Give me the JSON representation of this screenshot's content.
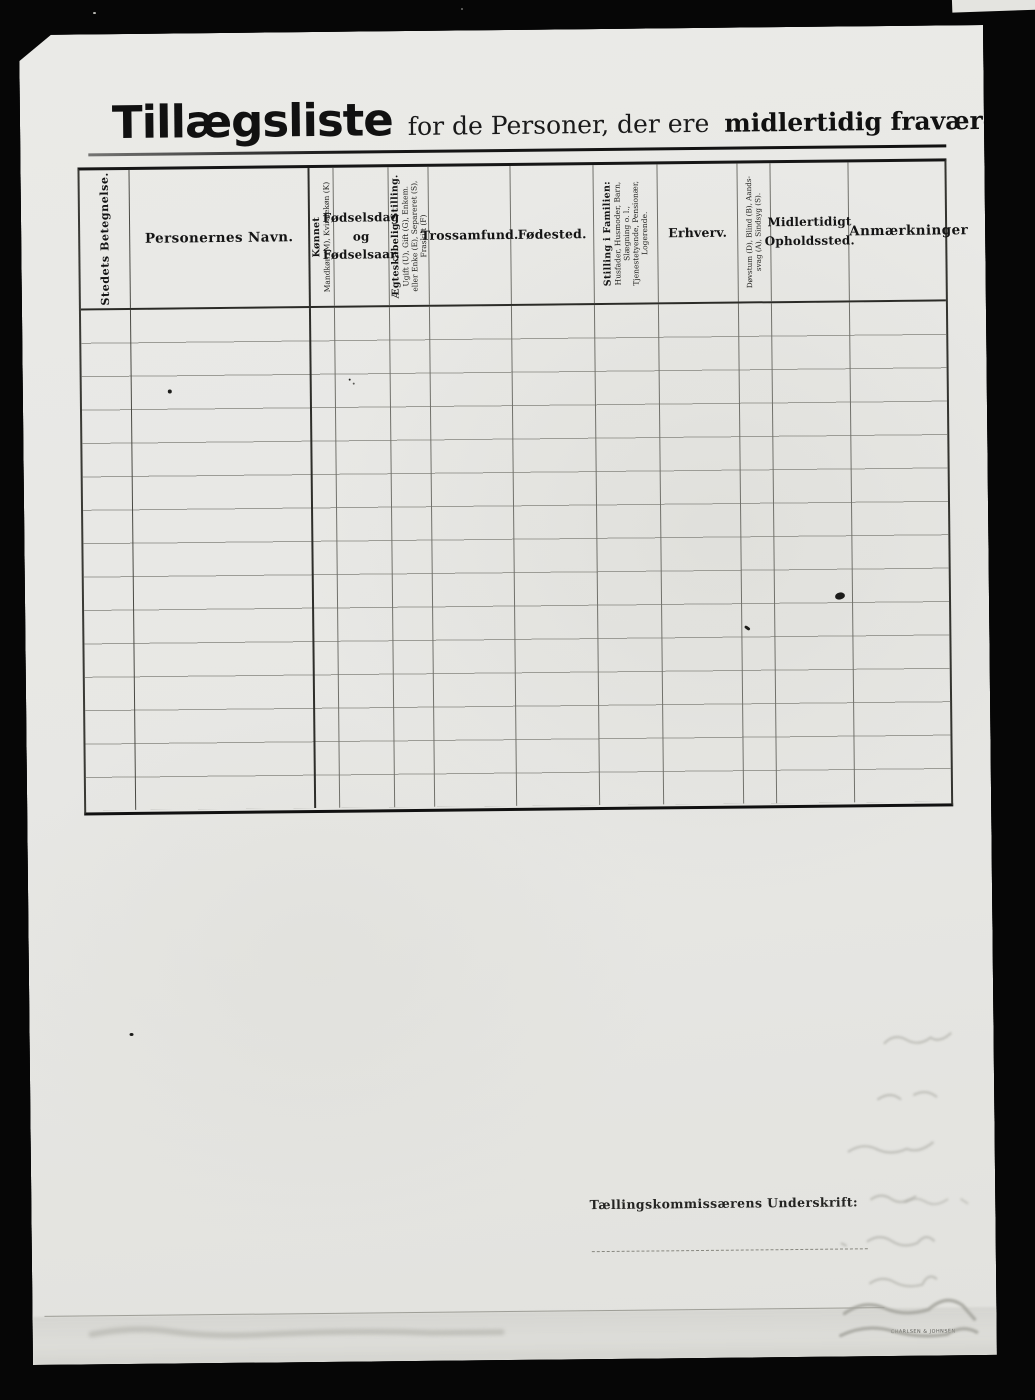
{
  "page_title": {
    "main": "Tillægsliste",
    "subtitle_regular": "for de Personer, der ere",
    "subtitle_bold": "midlertidig fraværende."
  },
  "table": {
    "columns": [
      {
        "id": "stedets-betegnelse",
        "orientation": "vertical",
        "lines": [
          "Stedets Betegnelse."
        ]
      },
      {
        "id": "personernes-navn",
        "orientation": "horizontal",
        "lines": [
          "Personernes Navn."
        ]
      },
      {
        "id": "koennet",
        "orientation": "vertical",
        "lines": [
          "Kønnet",
          "Mandkøn (M), Kvindekøn (K)"
        ]
      },
      {
        "id": "foedselsdag",
        "orientation": "horizontal",
        "lines": [
          "Fødselsdag",
          "og",
          "Fødselsaar."
        ]
      },
      {
        "id": "aegteskabelig-stilling",
        "orientation": "vertical",
        "lines": [
          "Ægteskabelig Stilling.",
          "Ugift (U), Gift (G), Enkem.",
          "eller Enke (E), Separeret (S),",
          "Fraskilt (F)"
        ]
      },
      {
        "id": "trossamfund",
        "orientation": "horizontal",
        "lines": [
          "Trossamfund."
        ]
      },
      {
        "id": "foedested",
        "orientation": "horizontal",
        "lines": [
          "Fødested."
        ]
      },
      {
        "id": "stilling-i-familien",
        "orientation": "vertical",
        "lines": [
          "Stilling i Familien:",
          "Husfader, Husmoder, Barn,",
          "Slægning o. l.,",
          "Tjenestetyende, Pensionær,",
          "Logerende."
        ]
      },
      {
        "id": "erhverv",
        "orientation": "horizontal",
        "lines": [
          "Erhverv."
        ]
      },
      {
        "id": "doevstum-blind",
        "orientation": "vertical",
        "lines": [
          "Døvstum (D), Blind (B), Aands-",
          "svag (A), Sindsyg (S)."
        ]
      },
      {
        "id": "midlertidigt-opholdssted",
        "orientation": "horizontal",
        "lines": [
          "Midlertidigt",
          "Opholdssted."
        ]
      },
      {
        "id": "anmaerkninger",
        "orientation": "horizontal",
        "lines": [
          "Anmærkninger"
        ]
      }
    ],
    "row_count": 15,
    "rows_empty": true
  },
  "footer": {
    "signature_label": "Tællingskommissærens Underskrift:",
    "signature_value": "",
    "printer_mark": "CHARLSEN & JOHNSEN"
  }
}
